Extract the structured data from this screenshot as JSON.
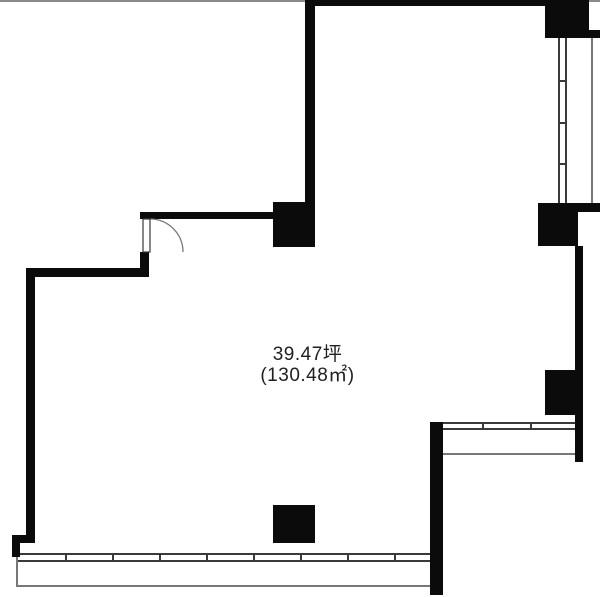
{
  "area_label": {
    "tsubo": "39.47坪",
    "sqm": "(130.48㎡)"
  },
  "colors": {
    "wall": "#0b0b0b",
    "window_line": "#3a3a3a",
    "thin_line": "#777777",
    "top_bar": "#8a8a8a",
    "text": "#1f1f1f",
    "background": "#ffffff"
  },
  "geometry": {
    "canvas": {
      "w": 600,
      "h": 597
    },
    "top_bar": {
      "x": 0,
      "y": 0,
      "w": 600,
      "h": 2
    },
    "walls": [
      {
        "name": "top-wall",
        "x": 305,
        "y": 0,
        "w": 240,
        "h": 6
      },
      {
        "name": "upper-left-wall",
        "x": 305,
        "y": 0,
        "w": 10,
        "h": 205
      },
      {
        "name": "pillar-top-center",
        "x": 273,
        "y": 202,
        "w": 42,
        "h": 45
      },
      {
        "name": "entry-top-wall",
        "x": 140,
        "y": 212,
        "w": 137,
        "h": 7
      },
      {
        "name": "entry-side-wall",
        "x": 140,
        "y": 252,
        "w": 9,
        "h": 25
      },
      {
        "name": "left-upper-wall",
        "x": 28,
        "y": 268,
        "w": 121,
        "h": 9
      },
      {
        "name": "left-wall",
        "x": 26,
        "y": 268,
        "w": 9,
        "h": 267
      },
      {
        "name": "left-jog-wall",
        "x": 12,
        "y": 535,
        "w": 23,
        "h": 8
      },
      {
        "name": "left-lower-wall",
        "x": 12,
        "y": 535,
        "w": 8,
        "h": 22
      },
      {
        "name": "pillar-top-right",
        "x": 545,
        "y": 0,
        "w": 44,
        "h": 38
      },
      {
        "name": "stub-top-right",
        "x": 589,
        "y": 30,
        "w": 11,
        "h": 8
      },
      {
        "name": "pillar-right-upper",
        "x": 538,
        "y": 203,
        "w": 40,
        "h": 43
      },
      {
        "name": "stub-right-upper",
        "x": 578,
        "y": 203,
        "w": 22,
        "h": 9
      },
      {
        "name": "right-wall",
        "x": 575,
        "y": 246,
        "w": 8,
        "h": 216
      },
      {
        "name": "pillar-right-lower",
        "x": 545,
        "y": 370,
        "w": 32,
        "h": 45
      },
      {
        "name": "lower-center-wall",
        "x": 430,
        "y": 422,
        "w": 13,
        "h": 173
      },
      {
        "name": "pillar-bottom-center",
        "x": 273,
        "y": 505,
        "w": 42,
        "h": 38
      }
    ],
    "windows": [
      {
        "name": "window-right",
        "dir": "v",
        "x": 558,
        "y": 38,
        "len": 165,
        "th": 9,
        "ticks": [
          42,
          84,
          125
        ]
      },
      {
        "name": "window-bottom",
        "dir": "h",
        "x": 18,
        "y": 553,
        "len": 412,
        "th": 9,
        "ticks": [
          47,
          94,
          141,
          188,
          235,
          282,
          329,
          376
        ]
      },
      {
        "name": "window-lower-right",
        "dir": "h",
        "x": 443,
        "y": 422,
        "len": 132,
        "th": 8,
        "ticks": [
          39,
          87
        ]
      }
    ],
    "thin_lines": [
      {
        "name": "balcony-edge-right",
        "x": 591,
        "y": 38,
        "w": 2,
        "h": 165
      },
      {
        "name": "balcony-edge-bottom",
        "x": 16,
        "y": 585,
        "w": 414,
        "h": 2
      },
      {
        "name": "balcony-edge-bottom-left",
        "x": 16,
        "y": 557,
        "w": 2,
        "h": 30
      },
      {
        "name": "balcony-edge-lower-right",
        "x": 443,
        "y": 453,
        "w": 132,
        "h": 2
      }
    ],
    "door": {
      "leaf": {
        "x": 143,
        "y": 219,
        "w": 7,
        "h": 33
      },
      "arc": {
        "sx": 150,
        "sy": 219,
        "ex": 183,
        "ey": 252,
        "r": 33
      }
    }
  }
}
